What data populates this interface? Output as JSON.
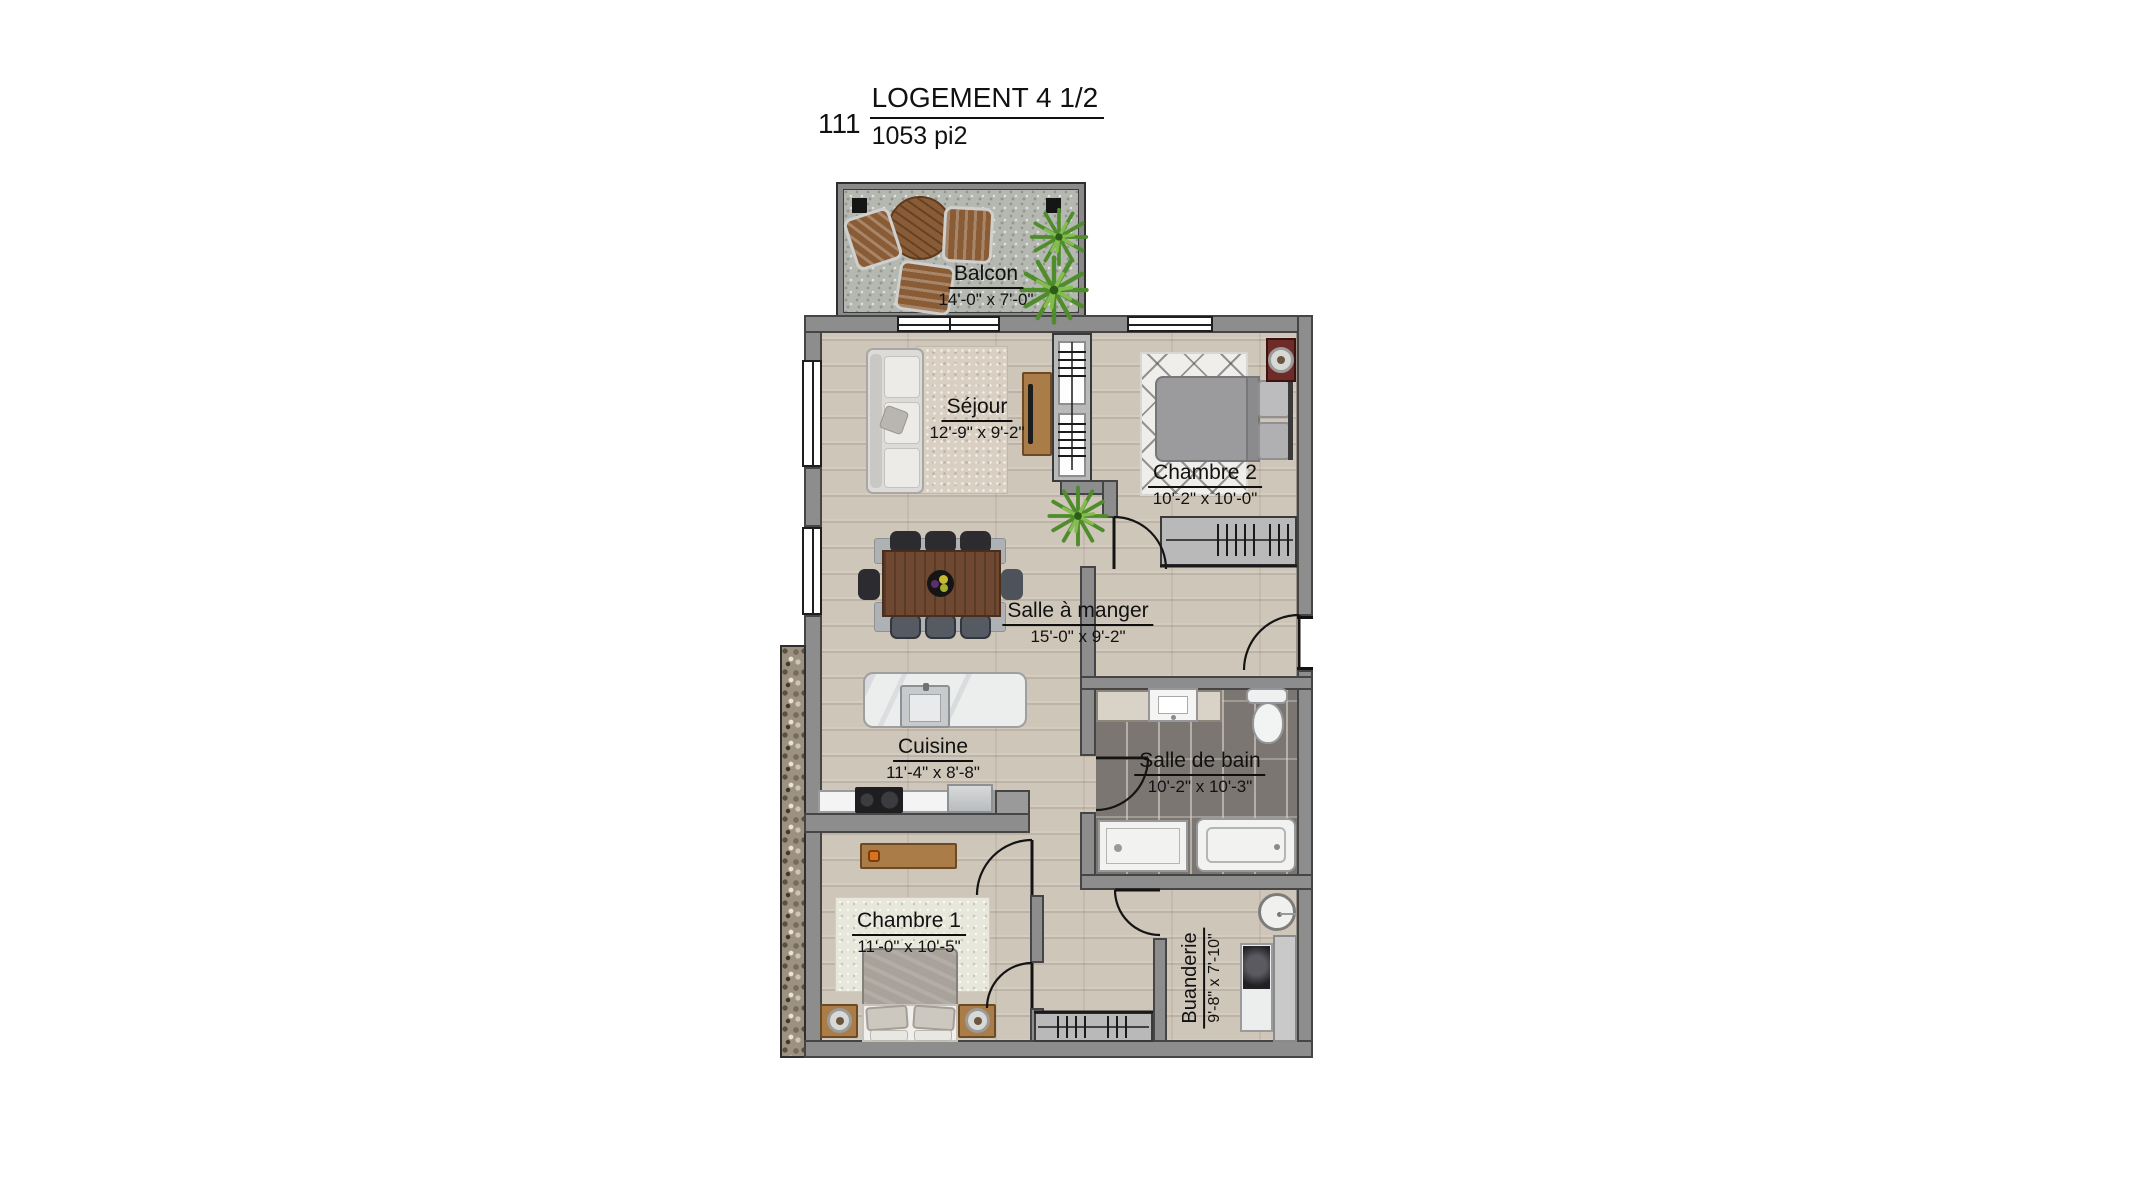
{
  "title": {
    "unit_number": "111",
    "name": "LOGEMENT 4 1/2",
    "area": "1053 pi2"
  },
  "rooms": [
    {
      "id": "balcon",
      "label": "Balcon",
      "dimensions": "14'-0\" x 7'-0\""
    },
    {
      "id": "sejour",
      "label": "Séjour",
      "dimensions": "12'-9\" x 9'-2\""
    },
    {
      "id": "chambre-2",
      "label": "Chambre 2",
      "dimensions": "10'-2\" x 10'-0\""
    },
    {
      "id": "salle-a-manger",
      "label": "Salle à manger",
      "dimensions": "15'-0\" x 9'-2\""
    },
    {
      "id": "cuisine",
      "label": "Cuisine",
      "dimensions": "11'-4\" x 8'-8\""
    },
    {
      "id": "salle-de-bain",
      "label": "Salle de bain",
      "dimensions": "10'-2\" x 10'-3\""
    },
    {
      "id": "chambre-1",
      "label": "Chambre 1",
      "dimensions": "11'-0\" x 10'-5\""
    },
    {
      "id": "buanderie",
      "label": "Buanderie",
      "dimensions": "9'-8\" x 7'-10\""
    }
  ],
  "colors": {
    "wall": "#8d8d8d",
    "wall_outline": "#454545",
    "floor_wood": "#cfc6ba",
    "bathroom_tile": "#7b7671",
    "balcony_concrete": "#b5b8b1",
    "exterior_stone": "#9d9181",
    "text": "#111111",
    "wood_furniture": "#a97c48",
    "dining_table": "#6f4831",
    "bed_gray": "#9b9b9d",
    "nightstand_red": "#6f2b27",
    "plant_green": "#4f8c2b"
  }
}
